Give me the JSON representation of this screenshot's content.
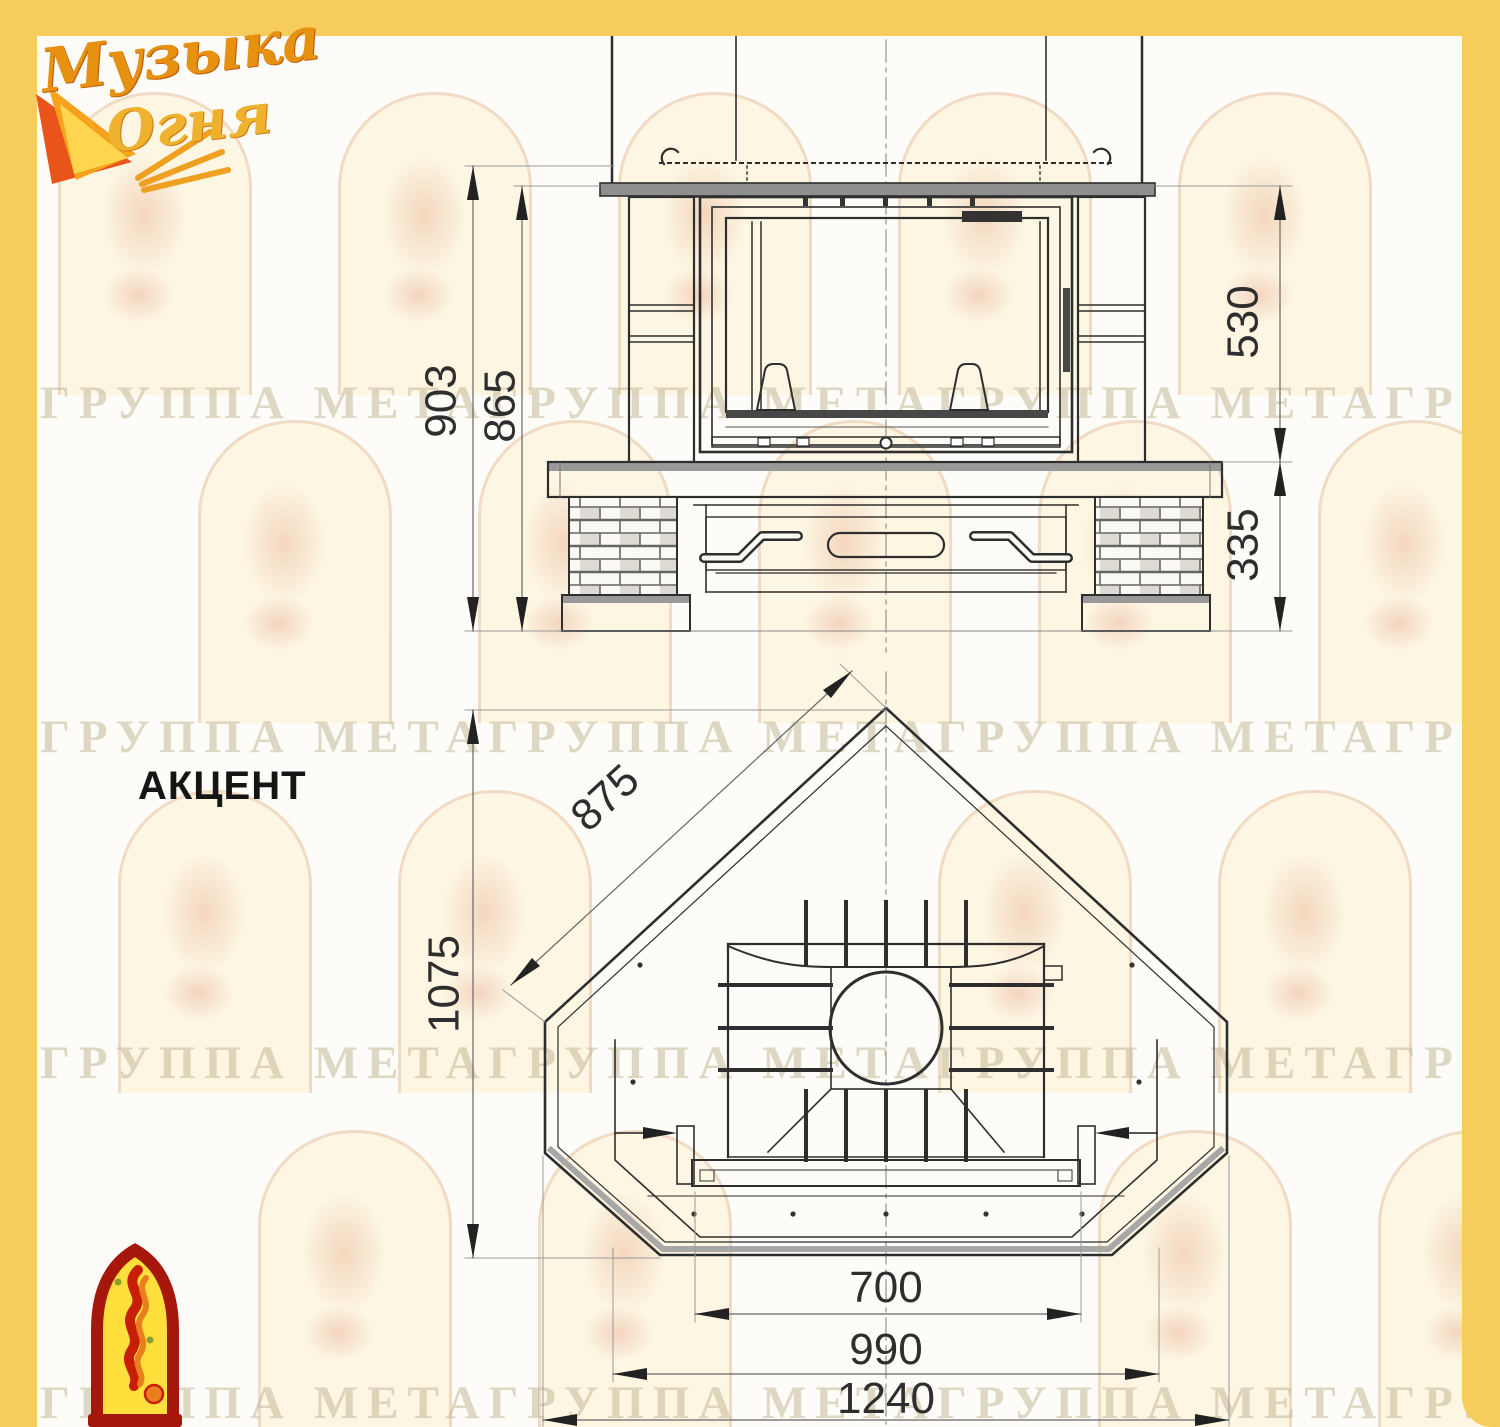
{
  "brand": {
    "name_line1": "Музыка",
    "name_line2": "Огня"
  },
  "model": {
    "title": "АКЦЕНТ"
  },
  "watermark": {
    "text_row": "ГРУППА МЕТАГРУППА МЕТАГРУППА МЕТАГРУППА МЕТА"
  },
  "front_view": {
    "dims": {
      "overall_height": "903",
      "shelf_height": "865",
      "firebox_height": "530",
      "base_height": "335"
    }
  },
  "plan_view": {
    "dims": {
      "depth": "1075",
      "side_edge": "875",
      "opening_width": "700",
      "inner_width": "990",
      "overall_width": "1240"
    }
  },
  "colors": {
    "frame_yellow": "#f6cc5d",
    "drawing_line": "#2e2e2e",
    "dimension_line": "#666666",
    "watermark_text": "#c5b899",
    "emblem_red": "#a6170b",
    "emblem_yellow": "#ffdf3c"
  }
}
